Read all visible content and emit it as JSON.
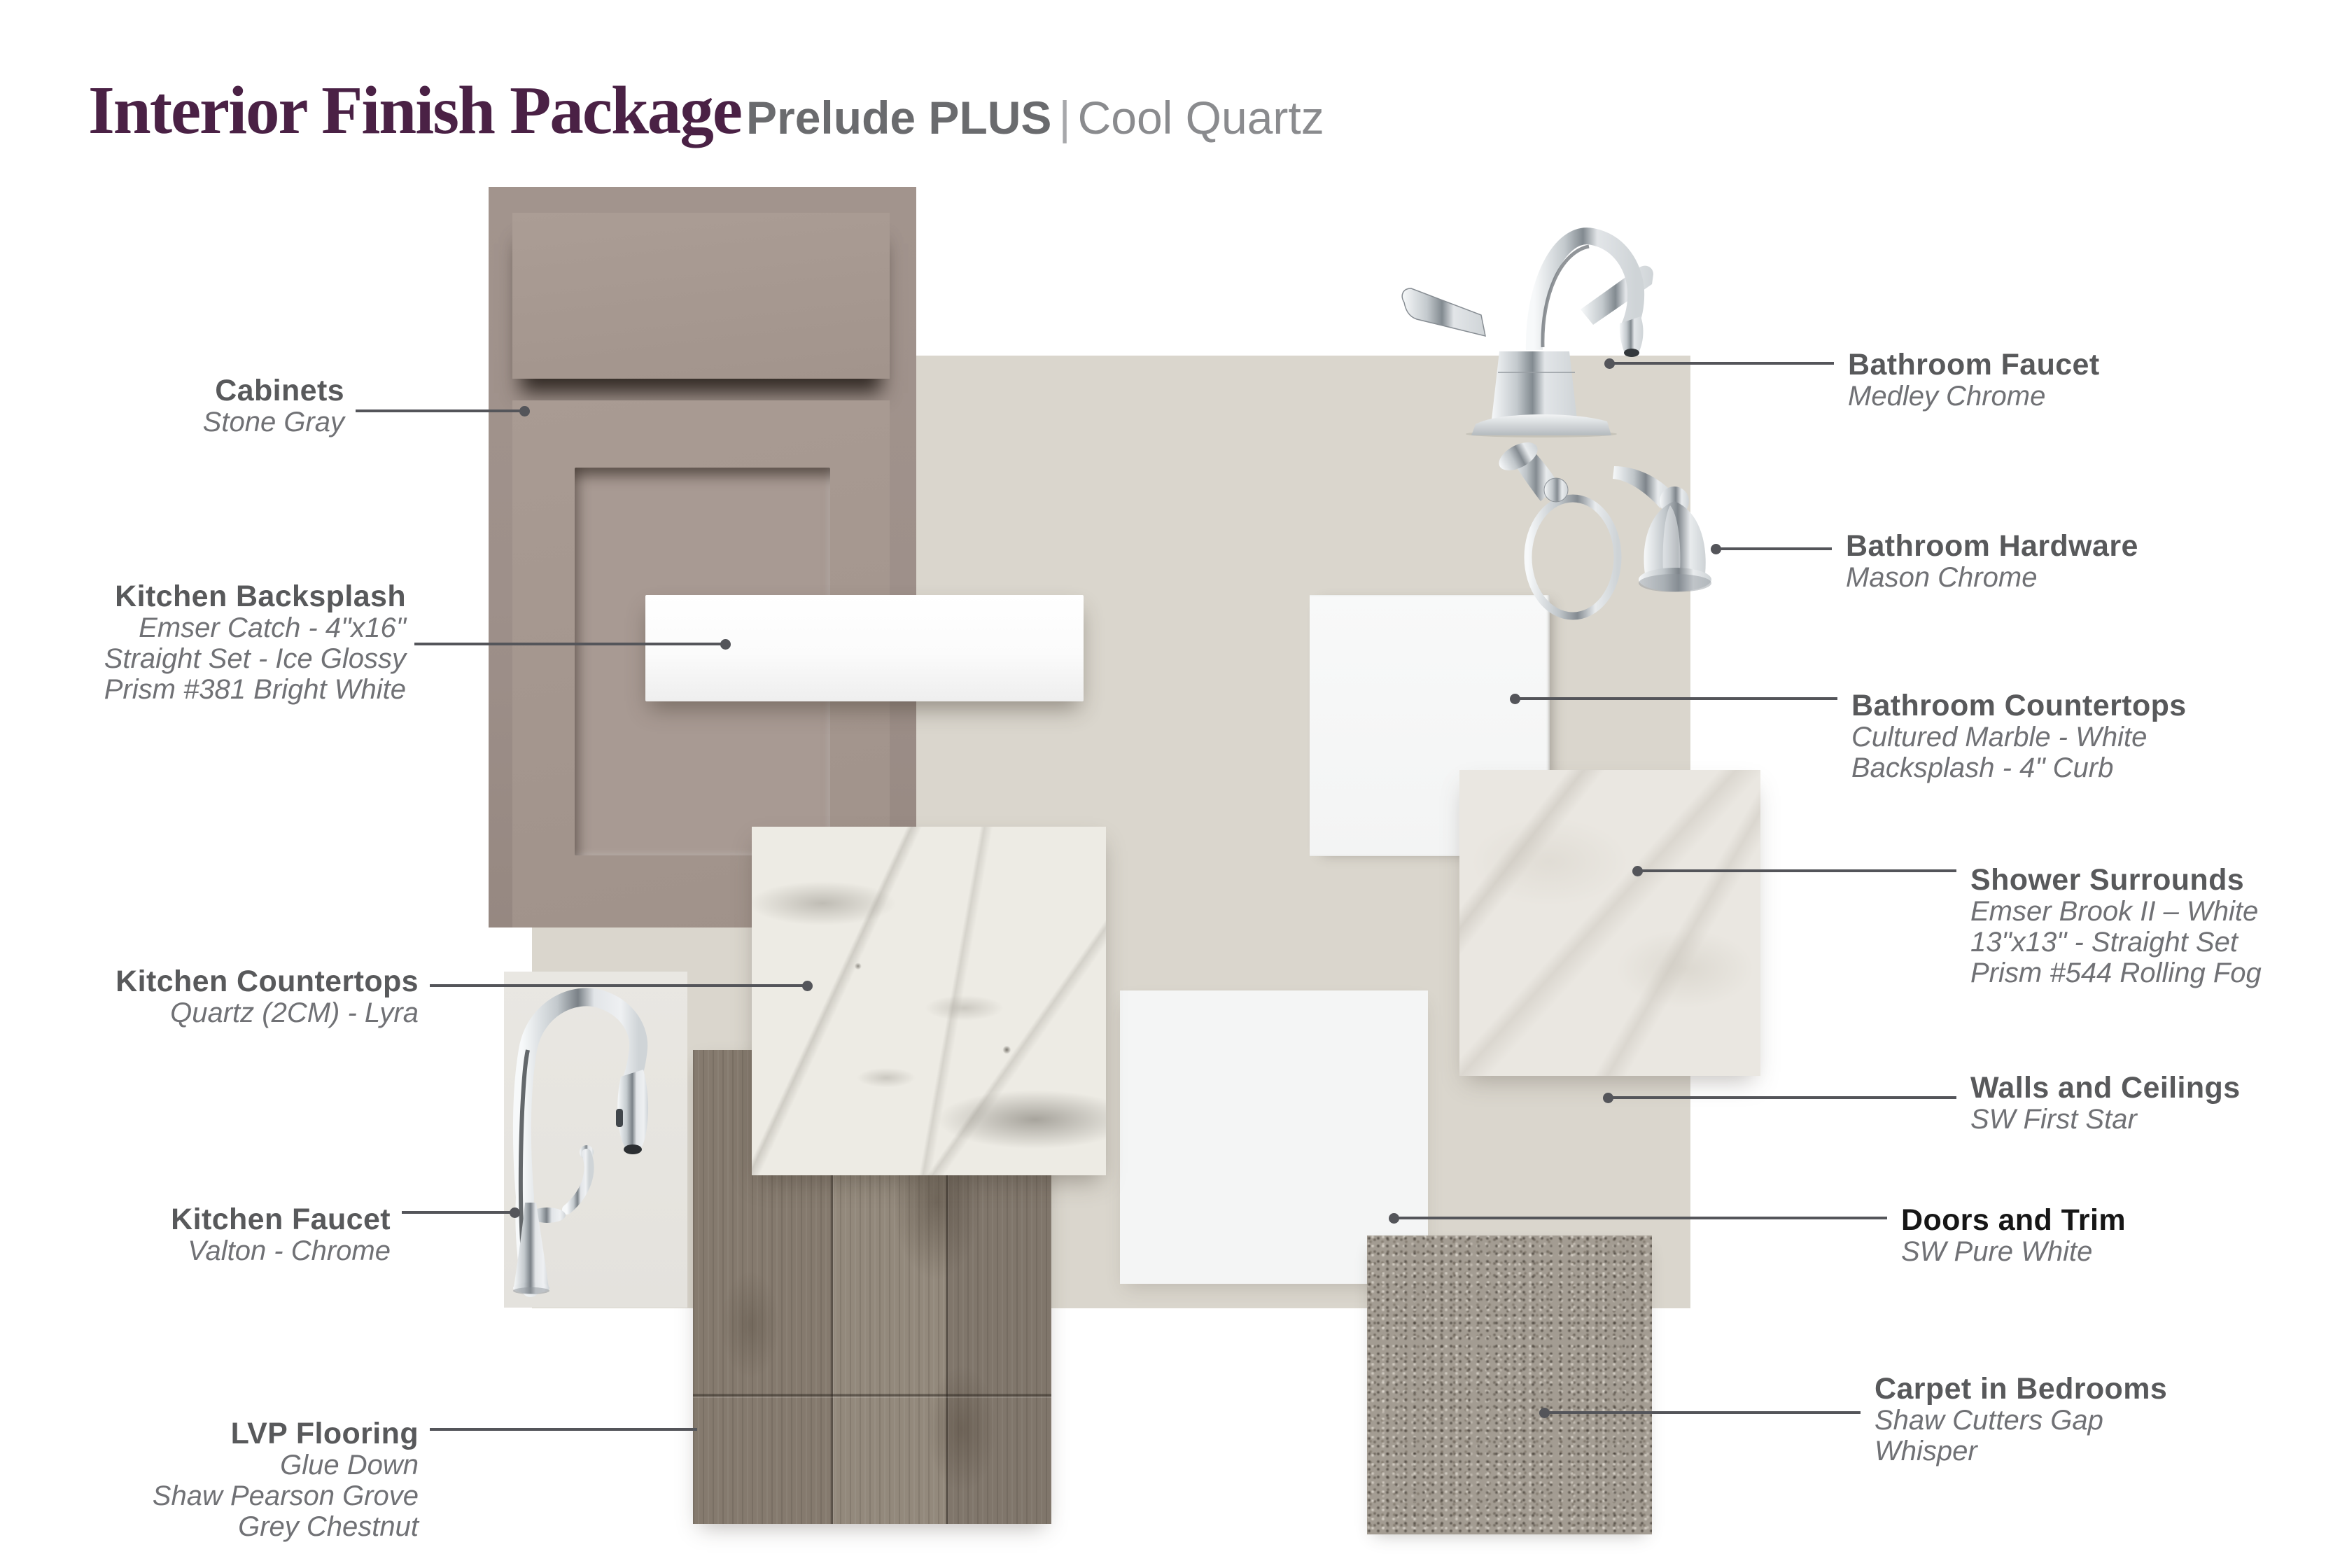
{
  "header": {
    "title": "Interior Finish Package",
    "package": "Prelude PLUS",
    "divider": "|",
    "variant": "Cool Quartz"
  },
  "labels": {
    "cabinets": {
      "title": "Cabinets",
      "lines": [
        "Stone Gray"
      ]
    },
    "kitchen_backsplash": {
      "title": "Kitchen Backsplash",
      "lines": [
        "Emser Catch - 4\"x16\"",
        "Straight Set - Ice Glossy",
        "Prism #381 Bright White"
      ]
    },
    "kitchen_countertops": {
      "title": "Kitchen Countertops",
      "lines": [
        "Quartz (2CM)  - Lyra"
      ]
    },
    "kitchen_faucet": {
      "title": "Kitchen Faucet",
      "lines": [
        "Valton - Chrome"
      ]
    },
    "lvp_flooring": {
      "title": "LVP Flooring",
      "lines": [
        "Glue Down",
        "Shaw Pearson Grove",
        "Grey Chestnut"
      ]
    },
    "bathroom_faucet": {
      "title": "Bathroom Faucet",
      "lines": [
        "Medley Chrome"
      ]
    },
    "bathroom_hardware": {
      "title": "Bathroom Hardware",
      "lines": [
        "Mason Chrome"
      ]
    },
    "bathroom_countertops": {
      "title": "Bathroom Countertops",
      "lines": [
        "Cultured Marble - White",
        "Backsplash - 4\" Curb"
      ]
    },
    "shower_surrounds": {
      "title": "Shower Surrounds",
      "lines": [
        "Emser Brook II – White",
        "13\"x13\" - Straight Set",
        "Prism #544 Rolling Fog"
      ]
    },
    "walls_ceilings": {
      "title": "Walls and Ceilings",
      "lines": [
        "SW First Star"
      ]
    },
    "doors_trim": {
      "title": "Doors and Trim",
      "lines": [
        "SW Pure White"
      ]
    },
    "carpet": {
      "title": "Carpet in Bedrooms",
      "lines": [
        "Shaw Cutters Gap",
        "Whisper"
      ]
    }
  },
  "colors": {
    "plum": "#4a2145",
    "title_gray": "#6a6b6e",
    "label": "#58595b",
    "sub": "#707175",
    "leader": "#54555a",
    "board": "#dad6cd",
    "cabinet": "#a5978f",
    "quartz": "#edebe4",
    "shower": "#eae7e1",
    "lvp": "#8a7f74",
    "carpet": "#a39c92",
    "chrome": "#aeb4b9"
  }
}
